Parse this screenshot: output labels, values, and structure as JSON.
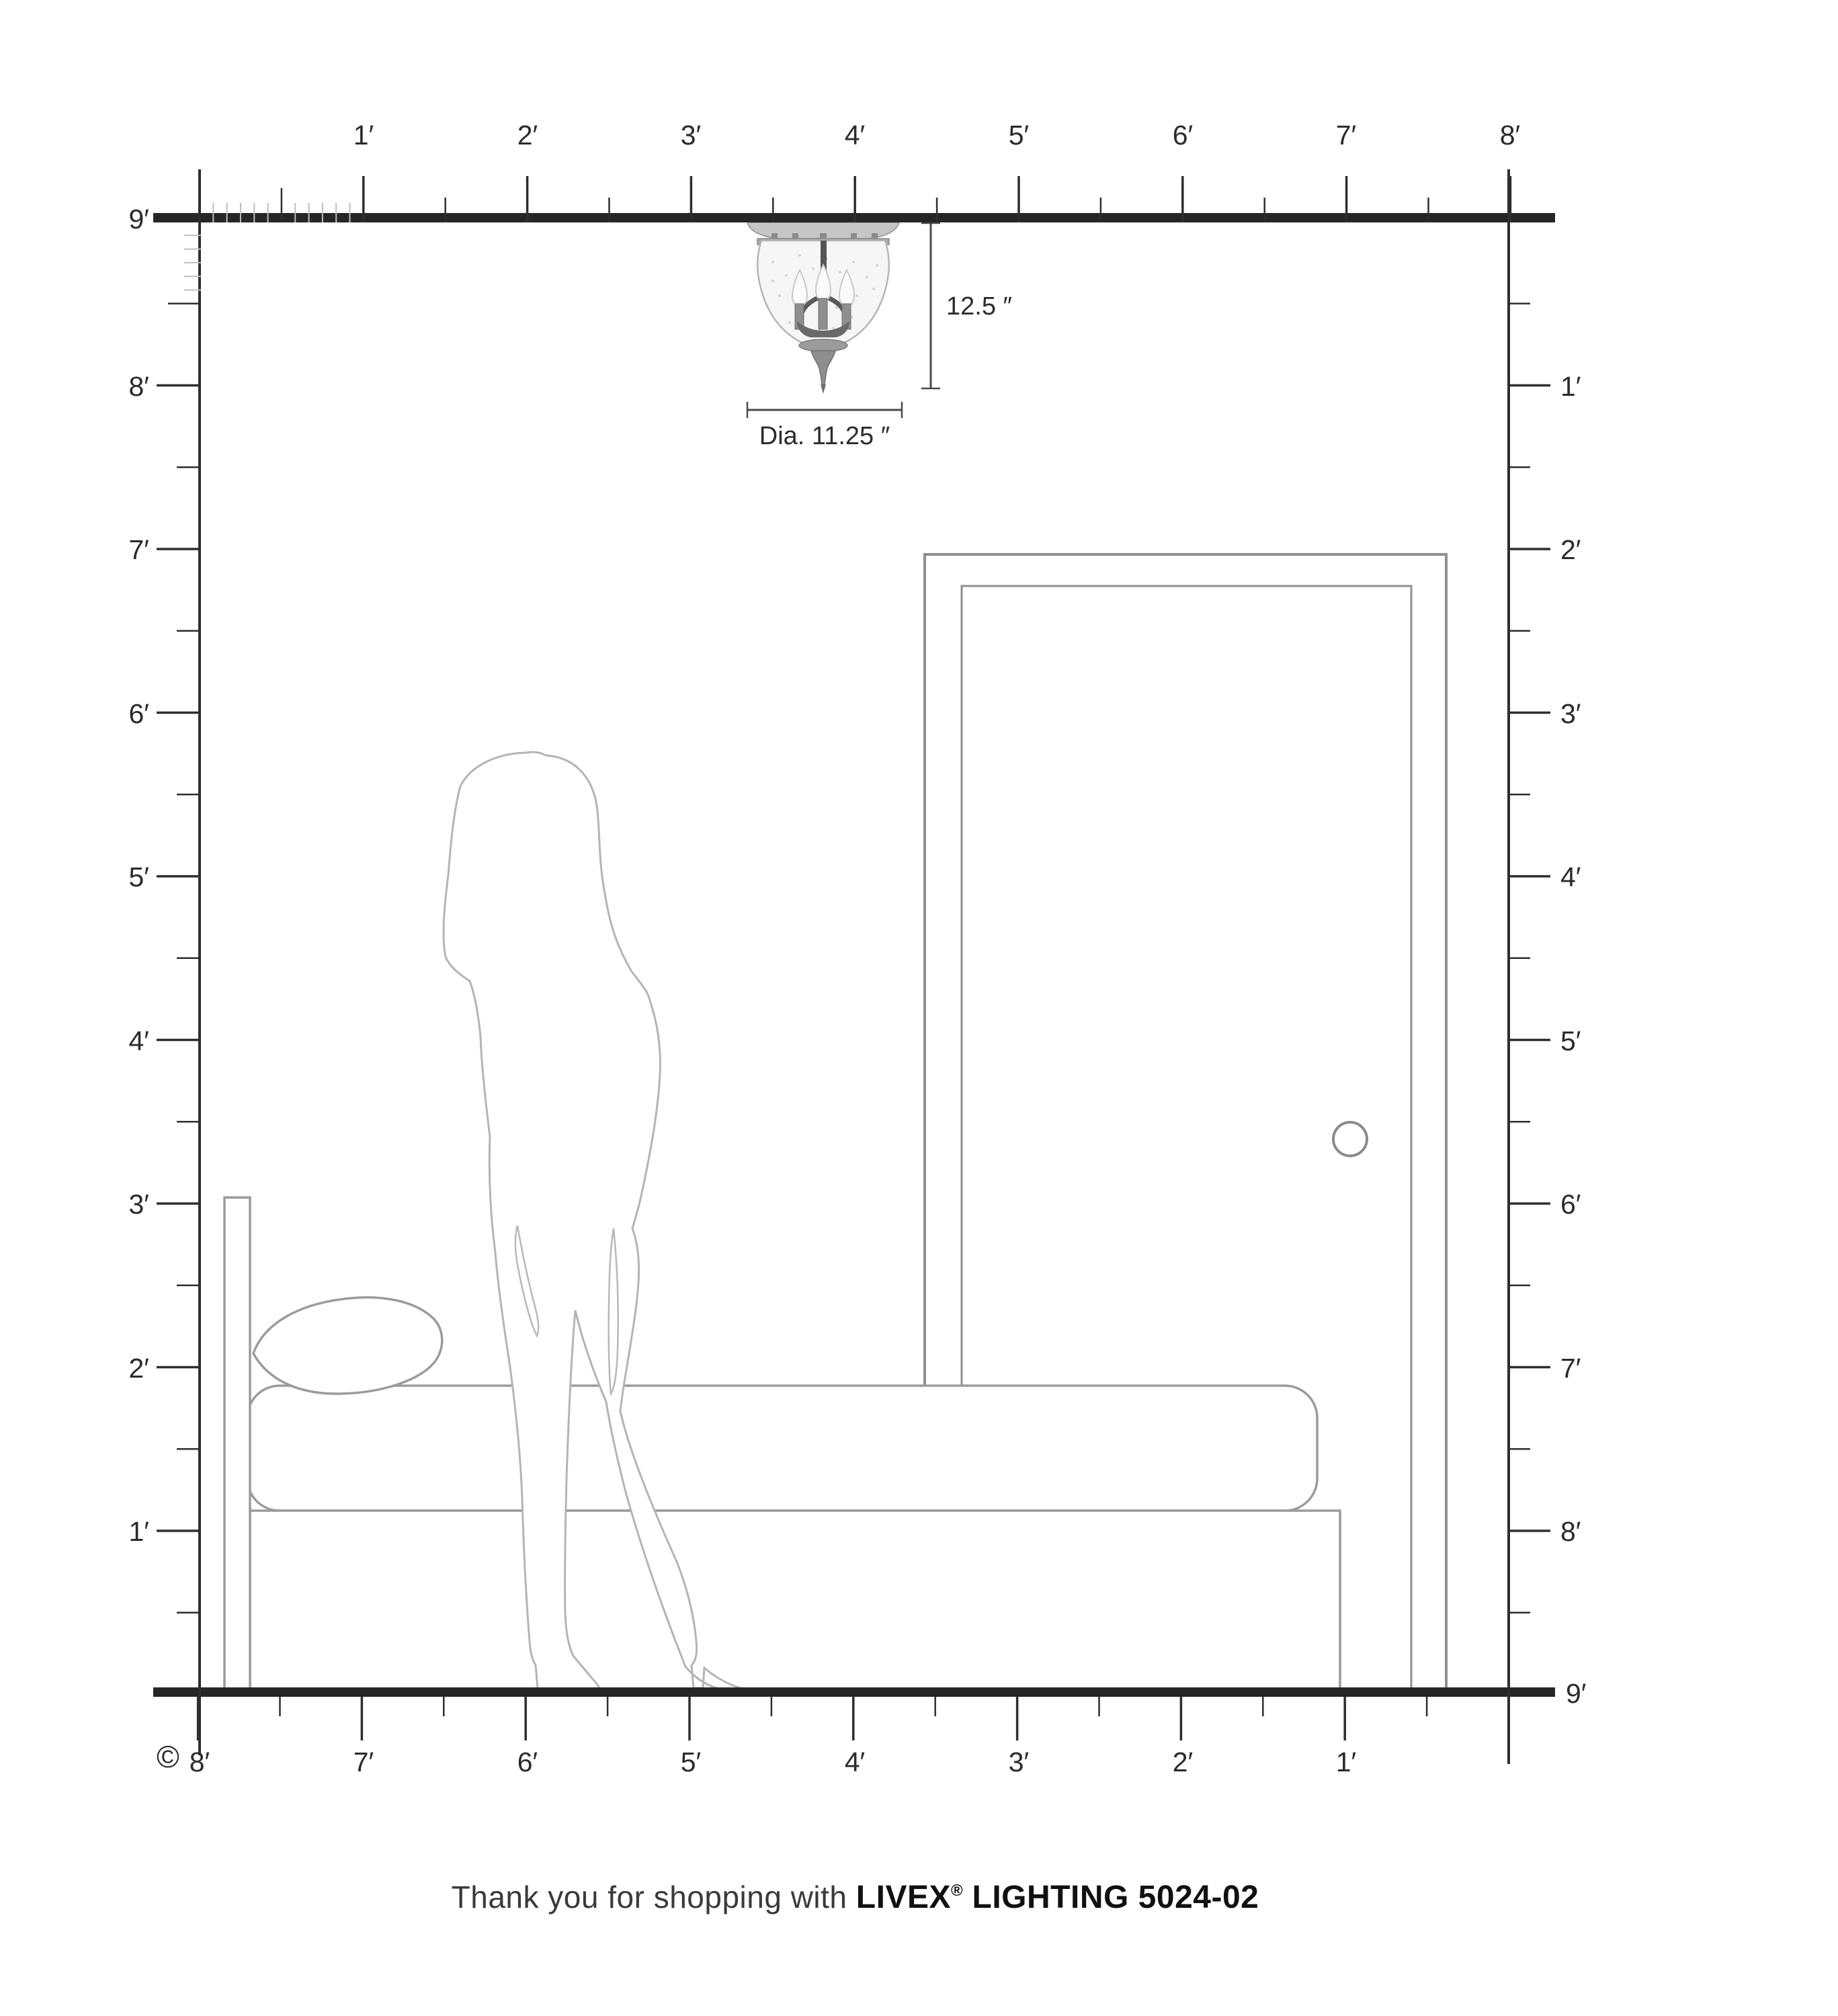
{
  "diagram": {
    "rulers": {
      "top": {
        "labels": [
          "1′",
          "2′",
          "3′",
          "4′",
          "5′",
          "6′",
          "7′",
          "8′"
        ]
      },
      "left": {
        "labels": [
          "9′",
          "8′",
          "7′",
          "6′",
          "5′",
          "4′",
          "3′",
          "2′",
          "1′"
        ]
      },
      "right": {
        "labels": [
          "1′",
          "2′",
          "3′",
          "4′",
          "5′",
          "6′",
          "7′",
          "8′",
          "9′"
        ]
      },
      "bottom": {
        "labels": [
          "8′",
          "7′",
          "6′",
          "5′",
          "4′",
          "3′",
          "2′",
          "1′"
        ]
      }
    },
    "fixture": {
      "height_label": "12.5 ″",
      "diameter_label": "Dia. 11.25 ″"
    },
    "copyright": "©",
    "footer": {
      "prefix": "Thank you for shopping with ",
      "brand": "LIVEX",
      "registered": "®",
      "suffix": " LIGHTING 5024-02"
    },
    "colors": {
      "bar": "#262626",
      "ruler": "#2e2e2e",
      "furniture_outline": "#9b9b9b",
      "figure_outline": "#b4b4b4",
      "metal": "#8f8f8f"
    }
  }
}
